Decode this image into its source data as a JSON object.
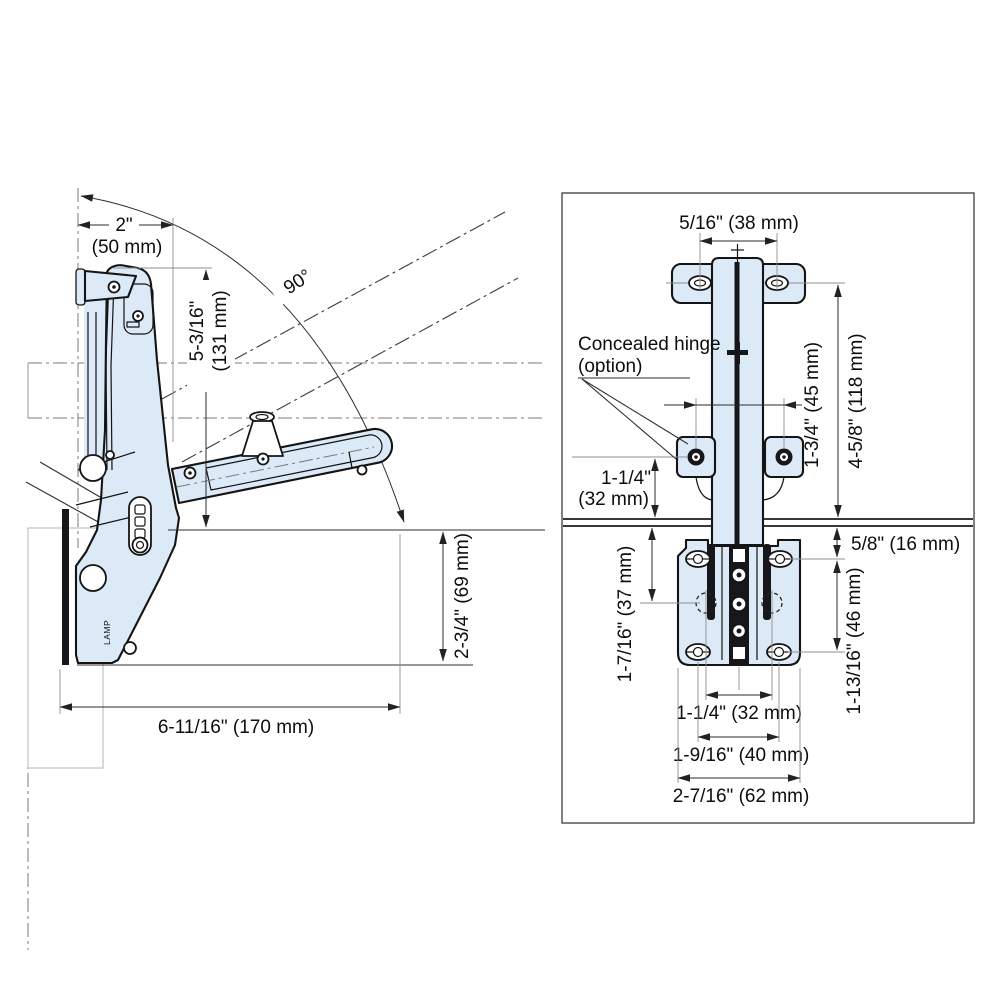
{
  "drawing_title": "Flap stay / drop hinge installation dimensions",
  "colors": {
    "part_fill": "#dce9f7",
    "outline": "#141414",
    "dim_line": "#2b2b2b",
    "extension_line": "#8f8f8f",
    "frame": "#555555",
    "text": "#0d0d0d"
  },
  "left_view": {
    "angle_label": "90°",
    "brand_mark": "LAMP",
    "dim_top_width_in": "2\"",
    "dim_top_width_mm": "(50 mm)",
    "dim_upper_height_in": "5-3/16\"",
    "dim_upper_height_mm": "(131 mm)",
    "dim_lower_height": "2-3/4\" (69 mm)",
    "dim_total_depth": "6-11/16\" (170 mm)"
  },
  "right_view": {
    "dim_slot_spacing": "5/16\" (38 mm)",
    "note_line1": "Concealed hinge",
    "note_line2": "(option)",
    "dim_screw_spacing": "1-3/4\" (45 mm)",
    "dim_overall_height": "4-5/8\" (118 mm)",
    "dim_offset_in": "1-1/4\"",
    "dim_offset_mm": "(32 mm)",
    "dim_top_clearance": "5/8\" (16 mm)",
    "dim_body_upper": "1-7/16\" (37 mm)",
    "dim_body_lower": "1-13/16\" (46 mm)",
    "dim_bottom_inner": "1-1/4\" (32 mm)",
    "dim_bottom_mid": "1-9/16\" (40 mm)",
    "dim_bottom_outer": "2-7/16\" (62 mm)"
  }
}
